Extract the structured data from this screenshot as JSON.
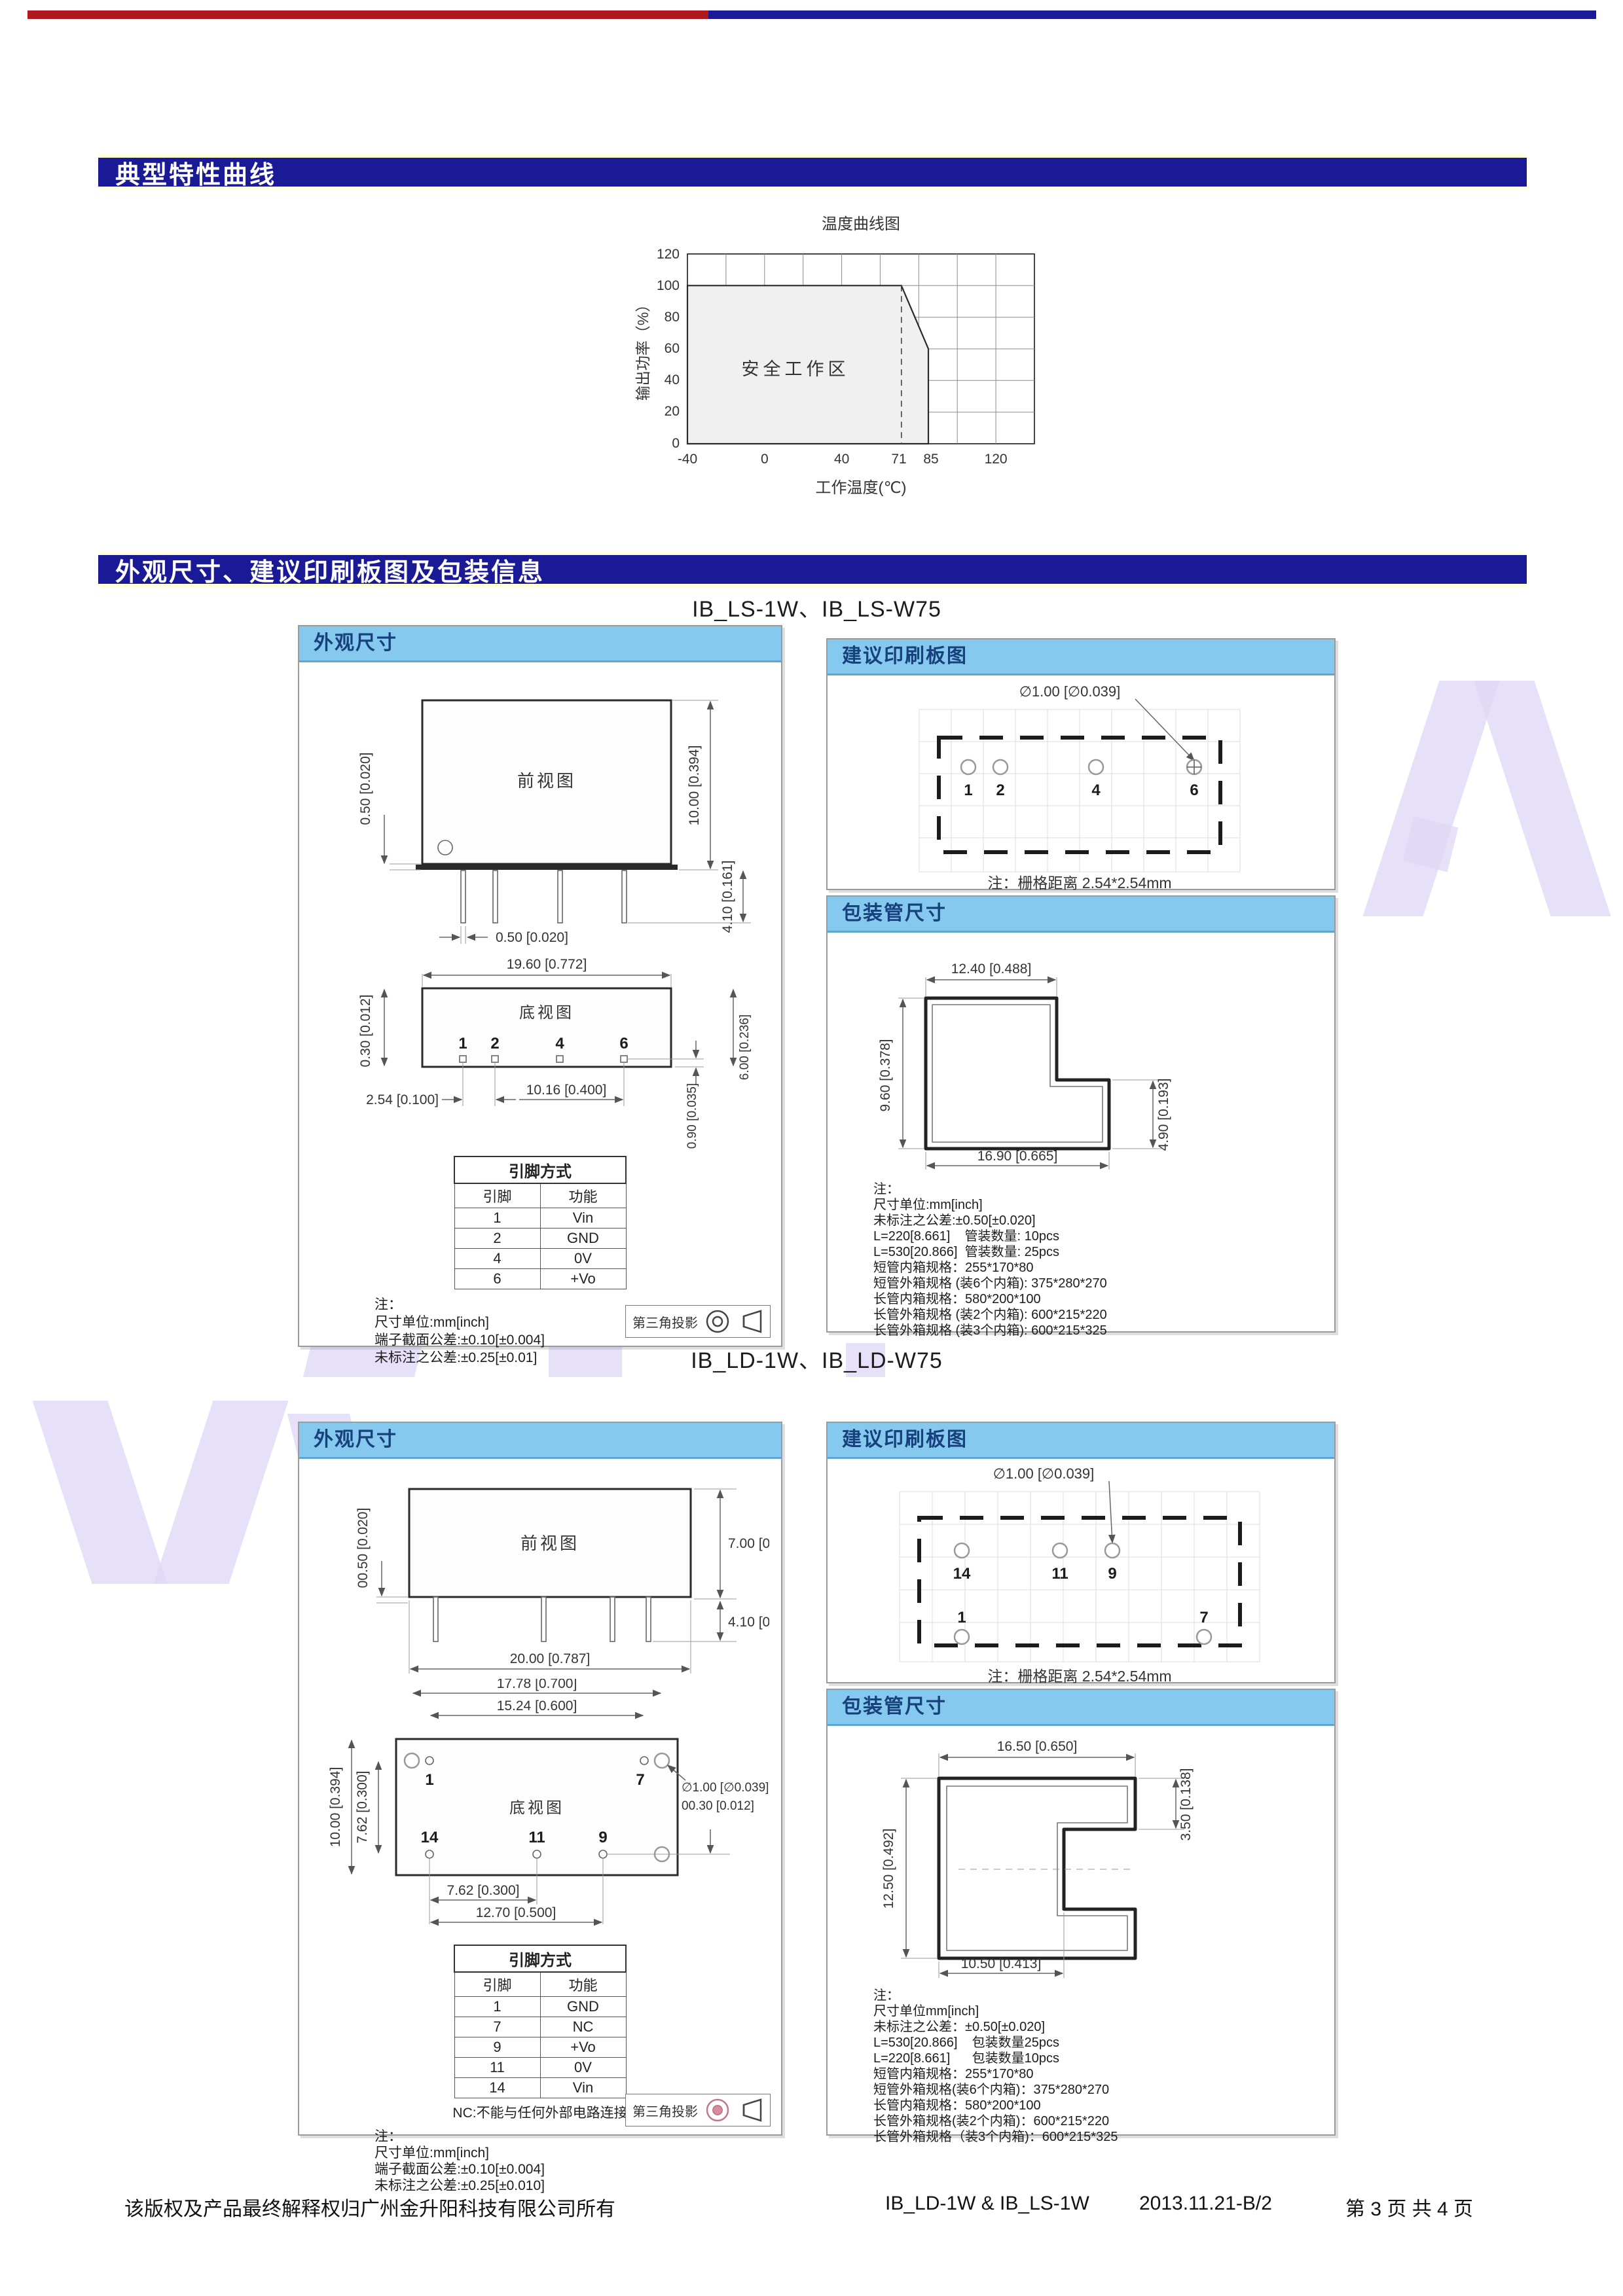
{
  "headers": {
    "h1": "典型特性曲线",
    "h2": "外观尺寸、建议印刷板图及包装信息"
  },
  "chart": {
    "title": "温度曲线图",
    "ylabel": "输出功率（%）",
    "xlabel": "工作温度(℃)",
    "area_label": "安全工作区",
    "yticks": [
      "120",
      "100",
      "80",
      "60",
      "40",
      "20",
      "0"
    ],
    "xticks": [
      "-40",
      "0",
      "40",
      "71",
      "85",
      "120"
    ]
  },
  "chart_data": {
    "type": "area",
    "title": "温度曲线图",
    "xlabel": "工作温度(℃)",
    "ylabel": "输出功率（%）",
    "x": [
      -40,
      71,
      85,
      85
    ],
    "y": [
      100,
      100,
      60,
      0
    ],
    "xticks": [
      -40,
      0,
      40,
      71,
      85,
      120
    ],
    "yticks": [
      0,
      20,
      40,
      60,
      80,
      100,
      120
    ],
    "xlim": [
      -40,
      140
    ],
    "ylim": [
      0,
      120
    ],
    "grid": true,
    "annotations": [
      "安全工作区"
    ],
    "dashed_line_x": 71
  },
  "sections": {
    "ls": {
      "title": "IB_LS-1W、IB_LS-W75",
      "outline": {
        "panel_title": "外观尺寸",
        "front": {
          "label": "前视图",
          "dim_left": "0.50 [0.020]",
          "dim_right1": "10.00 [0.394]",
          "dim_right2": "4.10 [0.161]",
          "dim_bottom": "0.50 [0.020]"
        },
        "bottom": {
          "label": "底视图",
          "dim_top": "19.60 [0.772]",
          "dim_left": "0.30 [0.012]",
          "dim_b1": "2.54 [0.100]",
          "dim_b2": "10.16 [0.400]",
          "dim_r1": "0.90 [0.035]",
          "dim_r2": "6.00 [0.236]",
          "pins": [
            "1",
            "2",
            "4",
            "6"
          ]
        }
      },
      "pin_table": {
        "title": "引脚方式",
        "col_pin": "引脚",
        "col_fn": "功能",
        "rows": [
          {
            "pin": "1",
            "fn": "Vin"
          },
          {
            "pin": "2",
            "fn": "GND"
          },
          {
            "pin": "4",
            "fn": "0V"
          },
          {
            "pin": "6",
            "fn": "+Vo"
          }
        ]
      },
      "notes": [
        "注：",
        "尺寸单位:mm[inch]",
        "端子截面公差:±0.10[±0.004]",
        "未标注之公差:±0.25[±0.01]"
      ],
      "projection": "第三角投影",
      "pcb": {
        "panel_title": "建议印刷板图",
        "hole": "∅1.00 [∅0.039]",
        "pads": [
          "1",
          "2",
          "4",
          "6"
        ],
        "note": "注：栅格距离 2.54*2.54mm"
      },
      "tube": {
        "panel_title": "包装管尺寸",
        "dim_top": "12.40 [0.488]",
        "dim_left": "9.60 [0.378]",
        "dim_right": "4.90 [0.193]",
        "dim_bottom": "16.90 [0.665]",
        "notes": [
          "注：",
          "尺寸单位:mm[inch]",
          "未标注之公差:±0.50[±0.020]",
          "L=220[8.661]    管装数量: 10pcs",
          "L=530[20.866]  管装数量: 25pcs",
          "短管内箱规格：255*170*80",
          "短管外箱规格 (装6个内箱): 375*280*270",
          "长管内箱规格：580*200*100",
          "长管外箱规格 (装2个内箱): 600*215*220",
          "长管外箱规格 (装3个内箱): 600*215*325"
        ]
      }
    },
    "ld": {
      "title": "IB_LD-1W、IB_LD-W75",
      "outline": {
        "panel_title": "外观尺寸",
        "front": {
          "label": "前视图",
          "dim_left": "00.50 [0.020]",
          "dim_right1": "7.00 [0.276]",
          "dim_right2": "4.10 [0.161]",
          "dim_bottom": "20.00 [0.787]"
        },
        "bottom": {
          "label": "底视图",
          "dim_1778": "17.78 [0.700]",
          "dim_1524": "15.24 [0.600]",
          "dim_left_outer": "10.00 [0.394]",
          "dim_left_inner": "7.62 [0.300]",
          "hole1": "∅1.00 [∅0.039]",
          "hole2": "00.30 [0.012]",
          "dim_b1": "7.62 [0.300]",
          "dim_b2": "12.70 [0.500]",
          "pins_top": [
            "1",
            "7"
          ],
          "pins_bottom": [
            "14",
            "11",
            "9"
          ]
        }
      },
      "pin_table": {
        "title": "引脚方式",
        "col_pin": "引脚",
        "col_fn": "功能",
        "rows": [
          {
            "pin": "1",
            "fn": "GND"
          },
          {
            "pin": "7",
            "fn": "NC"
          },
          {
            "pin": "9",
            "fn": "+Vo"
          },
          {
            "pin": "11",
            "fn": "0V"
          },
          {
            "pin": "14",
            "fn": "Vin"
          }
        ]
      },
      "nc_note": "NC:不能与任何外部电路连接",
      "notes": [
        "注：",
        "尺寸单位:mm[inch]",
        "端子截面公差:±0.10[±0.004]",
        "未标注之公差:±0.25[±0.010]"
      ],
      "projection": "第三角投影",
      "pcb": {
        "panel_title": "建议印刷板图",
        "hole": "∅1.00 [∅0.039]",
        "pads_top": [
          "14",
          "11",
          "9"
        ],
        "pads_bottom": [
          "1",
          "7"
        ],
        "note": "注：栅格距离 2.54*2.54mm"
      },
      "tube": {
        "panel_title": "包装管尺寸",
        "dim_top": "16.50 [0.650]",
        "dim_right": "3.50 [0.138]",
        "dim_left": "12.50 [0.492]",
        "dim_bottom": "10.50 [0.413]",
        "notes": [
          "注：",
          "尺寸单位mm[inch]",
          "未标注之公差：±0.50[±0.020]",
          "L=530[20.866]    包装数量25pcs",
          "L=220[8.661]      包装数量10pcs",
          "短管内箱规格：255*170*80",
          "短管外箱规格(装6个内箱)：375*280*270",
          "长管内箱规格：580*200*100",
          "长管外箱规格(装2个内箱)：600*215*220",
          "长管外箱规格（装3个内箱)：600*215*325"
        ]
      }
    }
  },
  "footer": {
    "copyright": "该版权及产品最终解释权归广州金升阳科技有限公司所有",
    "model": "IB_LD-1W & IB_LS-1W",
    "rev": "2013.11.21-B/2",
    "page": "第 3 页 共 4 页"
  },
  "colors": {
    "band_navy": "#1a1a96",
    "band_edge_cream": "#ffffd8",
    "panel_header_blue": "#85c9ef",
    "stripe_red": "#b01820",
    "watermark_lavender": "#ddd7f5"
  }
}
